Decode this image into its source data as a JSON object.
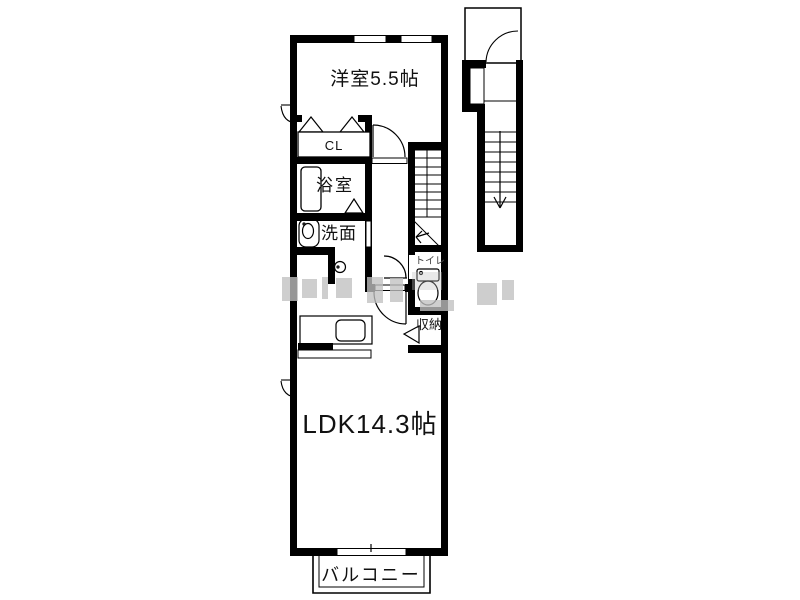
{
  "floorplan": {
    "rooms": {
      "western_room": {
        "label": "洋室5.5帖"
      },
      "closet": {
        "label": "CL"
      },
      "bathroom": {
        "label": "浴室"
      },
      "washroom": {
        "label": "洗面"
      },
      "toilet": {
        "label": "トイレ"
      },
      "storage": {
        "label": "収納"
      },
      "ldk": {
        "label": "LDK14.3帖"
      },
      "balcony": {
        "label": "バルコニー"
      }
    },
    "colors": {
      "wall": "#000000",
      "background": "#ffffff",
      "watermark": "#c0c0c0"
    }
  }
}
